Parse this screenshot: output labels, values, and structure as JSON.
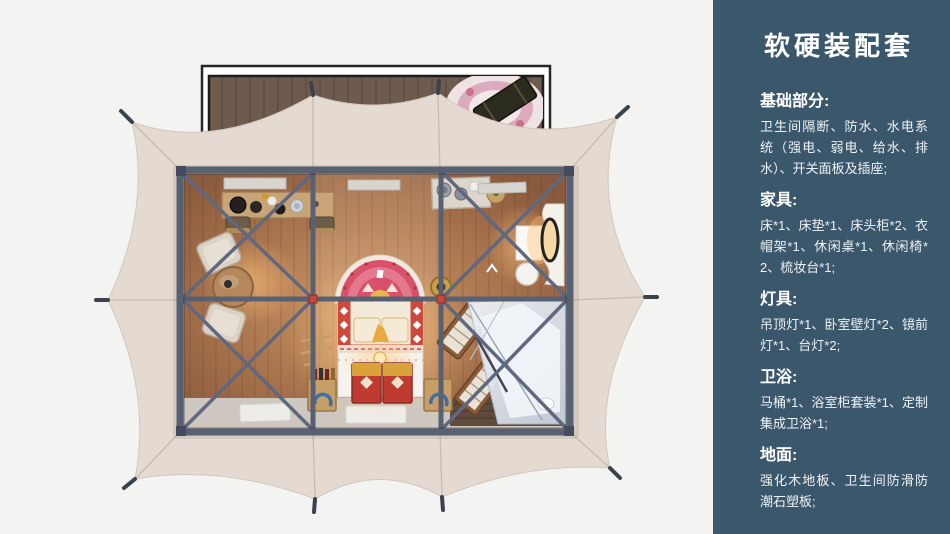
{
  "background_color": "#f3f3f2",
  "panel": {
    "bg_color": "#3b576c",
    "text_color": "#ffffff",
    "title": "软硬装配套",
    "sections": [
      {
        "label": "基础部分:",
        "body": "卫生间隔断、防水、水电系统（强电、弱电、给水、排水）、开关面板及插座;"
      },
      {
        "label": "家具:",
        "body": "床*1、床垫*1、床头柜*2、衣帽架*1、休闲桌*1、休闲椅*2、梳妆台*1;"
      },
      {
        "label": "灯具:",
        "body": "吊顶灯*1、卧室壁灯*2、镜前灯*1、台灯*2;"
      },
      {
        "label": "卫浴:",
        "body": "马桶*1、浴室柜套装*1、定制集成卫浴*1;"
      },
      {
        "label": "地面:",
        "body": "强化木地板、卫生间防滑防潮石塑板;"
      }
    ]
  },
  "illustration": {
    "subject": "帐篷客房俯视平面渲染图",
    "tent_canvas_color": "#e4dad2",
    "frame_color": "#596072",
    "wood_floor_color": "#b07a52",
    "deck_wood_color": "#6e5b4d"
  }
}
